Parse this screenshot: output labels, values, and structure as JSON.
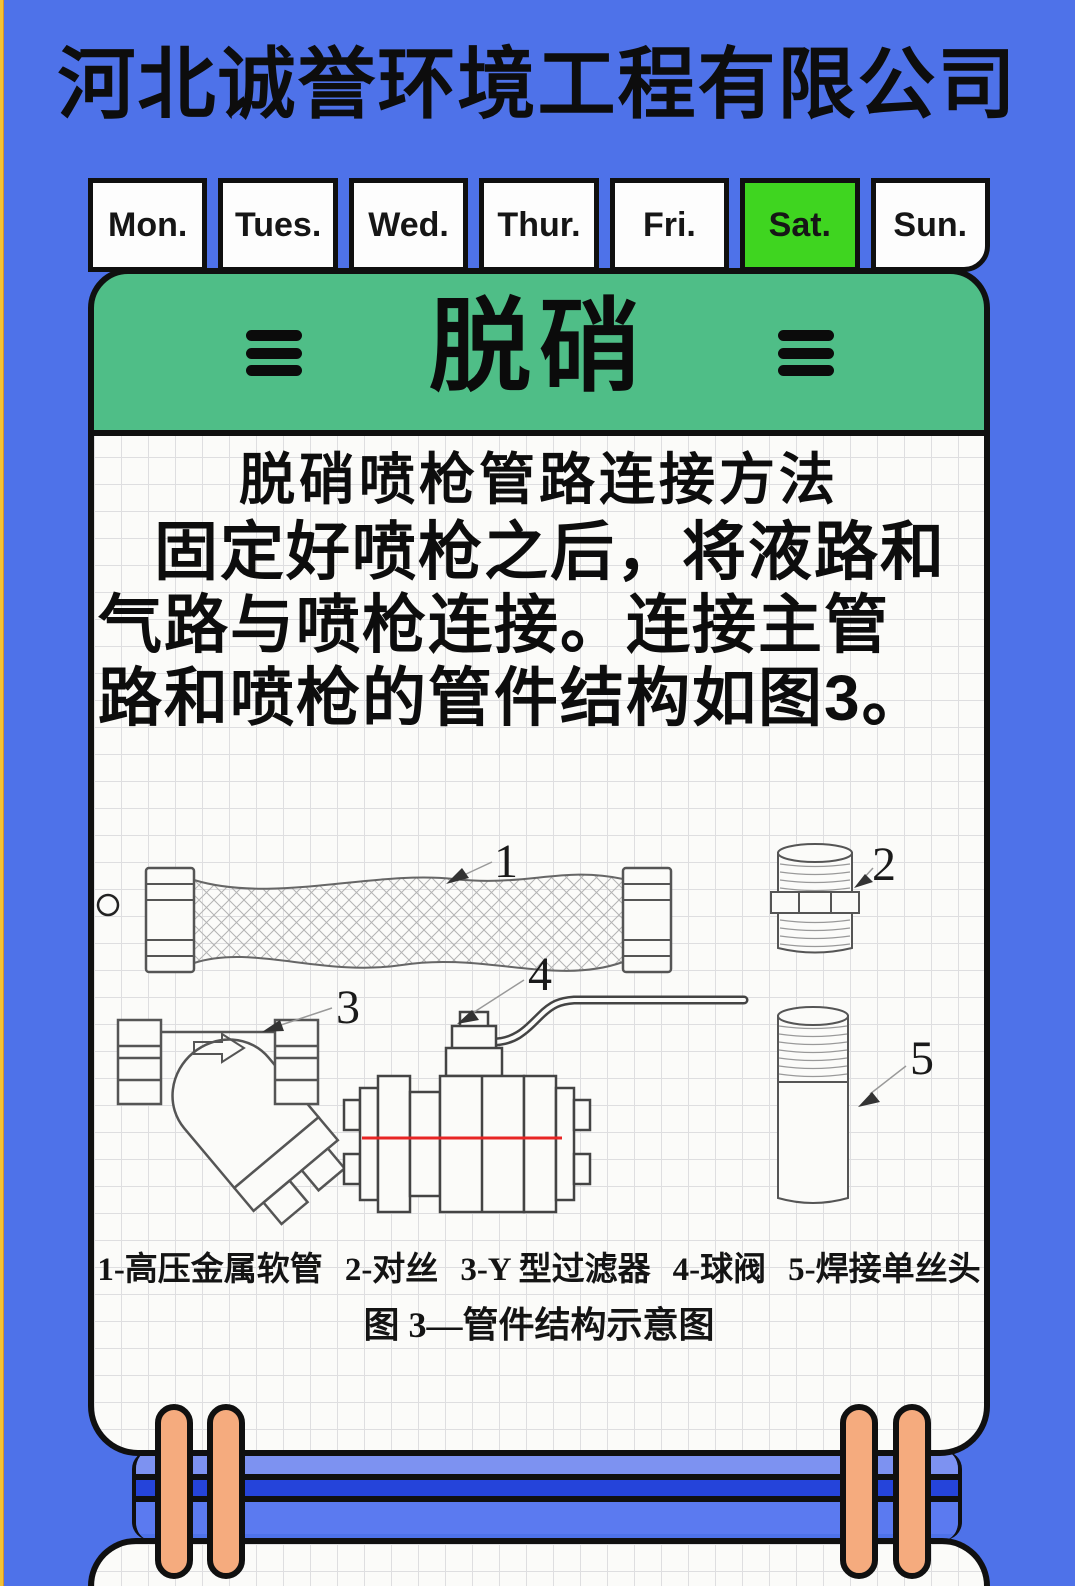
{
  "colors": {
    "background_blue": "#4e72e9",
    "edge_stripe_yellow": "#f2c235",
    "header_green": "#4fbe87",
    "active_tab_green": "#3fd520",
    "ring_orange": "#f5ab7e",
    "band_light_blue": "#7d92f1",
    "band_dark_blue": "#2544da",
    "band_mid_blue": "#5b7af0",
    "valve_red_line": "#e82525"
  },
  "icons": {
    "menu": "hamburger-icon"
  },
  "company_title": "河北诚誉环境工程有限公司",
  "calendar": {
    "tabs": [
      {
        "label": "Mon.",
        "active": false
      },
      {
        "label": "Tues.",
        "active": false
      },
      {
        "label": "Wed.",
        "active": false
      },
      {
        "label": "Thur.",
        "active": false
      },
      {
        "label": "Fri.",
        "active": false
      },
      {
        "label": "Sat.",
        "active": true
      },
      {
        "label": "Sun.",
        "active": false
      }
    ]
  },
  "notepad": {
    "header_title": "脱硝",
    "article": {
      "heading": "脱硝喷枪管路连接方法",
      "lines": [
        "固定好喷枪之后，将液路和",
        "气路与喷枪连接。连接主管",
        "路和喷枪的管件结构如图3。"
      ]
    },
    "figure": {
      "parts": [
        {
          "num": "1",
          "name": "高压金属软管"
        },
        {
          "num": "2",
          "name": "对丝"
        },
        {
          "num": "3",
          "name": "Y 型过滤器"
        },
        {
          "num": "4",
          "name": "球阀"
        },
        {
          "num": "5",
          "name": "焊接单丝头"
        }
      ],
      "legend_items": [
        "1-高压金属软管",
        "2-对丝",
        "3-Y 型过滤器",
        "4-球阀",
        "5-焊接单丝头"
      ],
      "caption": "图 3—管件结构示意图"
    }
  }
}
